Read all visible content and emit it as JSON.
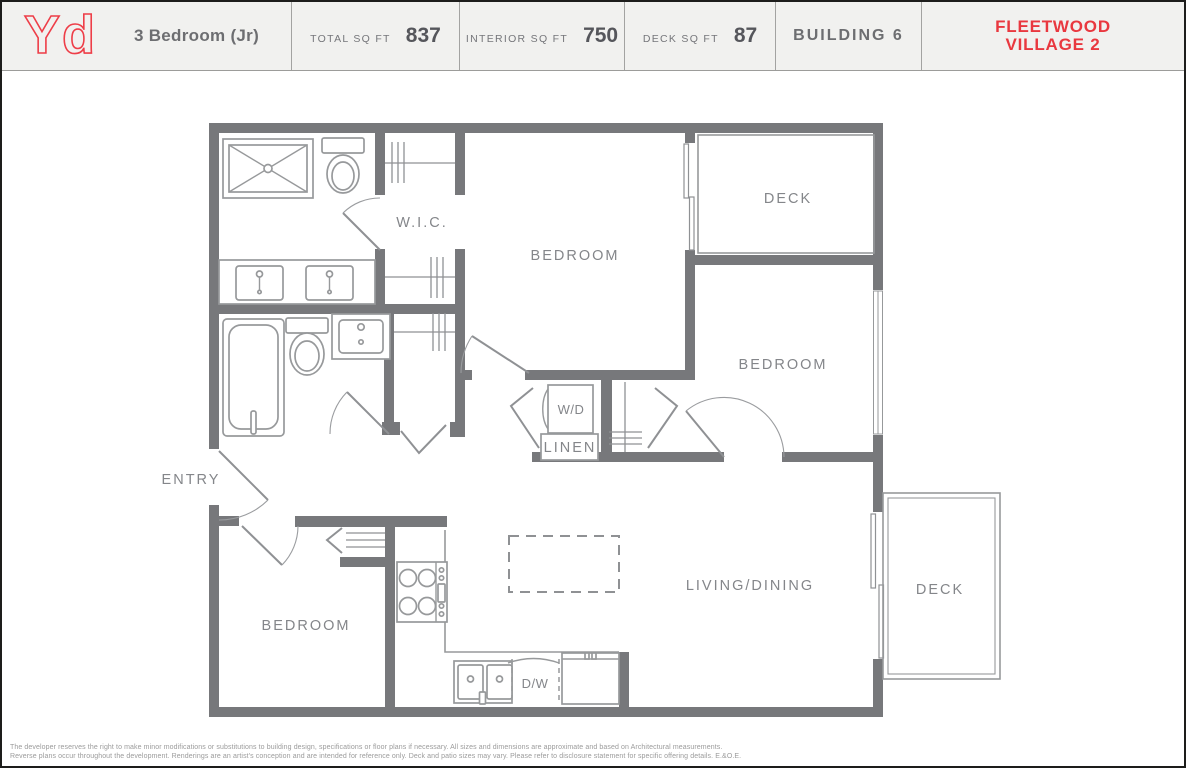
{
  "header": {
    "logo": "Yd",
    "plan_name": "3 Bedroom (Jr)",
    "stats": [
      {
        "label": "TOTAL SQ FT",
        "value": "837"
      },
      {
        "label": "INTERIOR SQ FT",
        "value": "750"
      },
      {
        "label": "DECK SQ FT",
        "value": "87"
      }
    ],
    "building": "BUILDING 6",
    "brand_line1": "FLEETWOOD",
    "brand_line2": "VILLAGE 2",
    "accent_color": "#e9383f",
    "text_color": "#6d6e71"
  },
  "plan": {
    "wall_color": "#77787b",
    "fixture_color": "#97999b",
    "label_color": "#84868a",
    "labels": {
      "wic": "W.I.C.",
      "bedroom_top": "BEDROOM",
      "deck_top": "DECK",
      "bedroom_right": "BEDROOM",
      "wd": "W/D",
      "linen": "LINEN",
      "entry": "ENTRY",
      "bedroom_left": "BEDROOM",
      "living": "LIVING/DINING",
      "deck_right": "DECK",
      "dw": "D/W"
    }
  },
  "footer": {
    "line1": "The developer reserves the right to make minor modifications or substitutions to building design, specifications or floor plans if necessary. All sizes and dimensions are approximate and based on Architectural measurements.",
    "line2": "Reverse plans occur throughout the development. Renderings are an artist's conception and are intended for reference only. Deck and patio sizes may vary. Please refer to disclosure statement for specific offering details. E.&O.E."
  }
}
